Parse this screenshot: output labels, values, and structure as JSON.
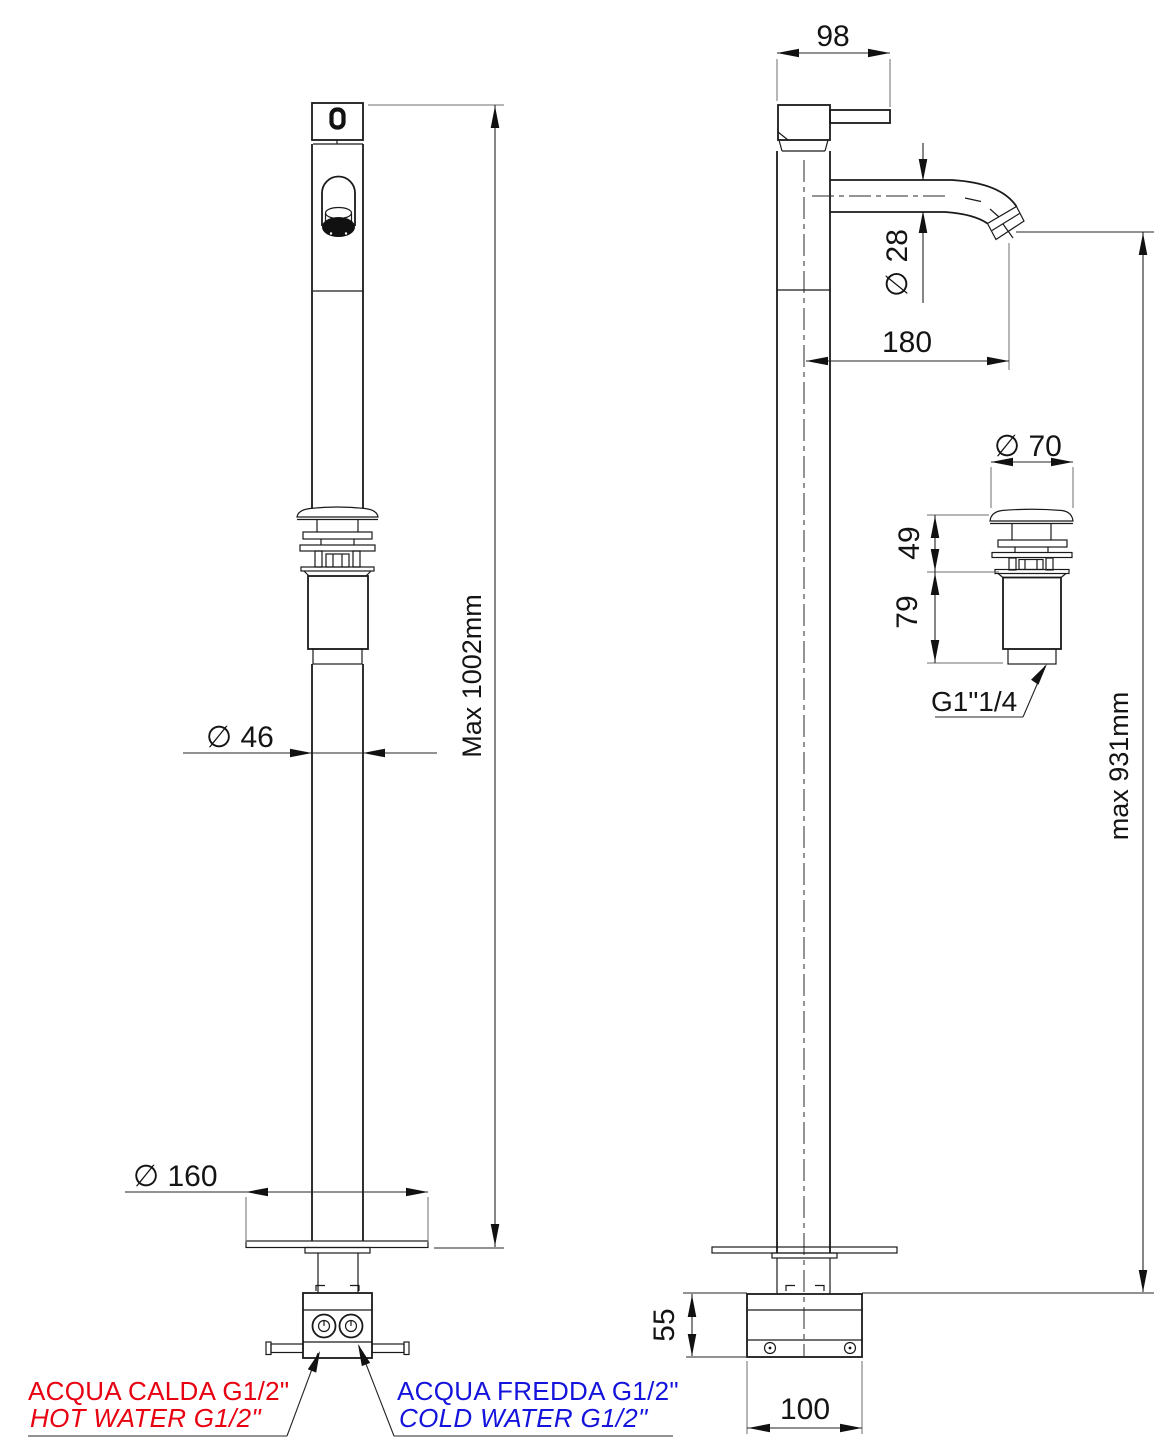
{
  "drawing": {
    "front": {
      "height_max": "Max 1002mm",
      "column_diameter": "∅ 46",
      "base_plate_diameter": "∅ 160"
    },
    "side": {
      "handle_width": "98",
      "spout_tube_diameter": "∅ 28",
      "spout_reach": "180",
      "spout_height_max": "max 931mm",
      "under_floor_box_height": "55",
      "under_floor_box_width": "100"
    },
    "drain": {
      "cap_diameter": "∅ 70",
      "upper_height": "49",
      "body_height": "79",
      "thread": "G1\"1/4"
    },
    "connections": {
      "hot_line1": "ACQUA CALDA G1/2\"",
      "hot_line2": "HOT WATER G1/2\"",
      "cold_line1": "ACQUA FREDDA G1/2\"",
      "cold_line2": "COLD WATER G1/2\""
    },
    "colors": {
      "hot": "#e80011",
      "cold": "#1414dc",
      "line": "#1a1a1a"
    }
  }
}
